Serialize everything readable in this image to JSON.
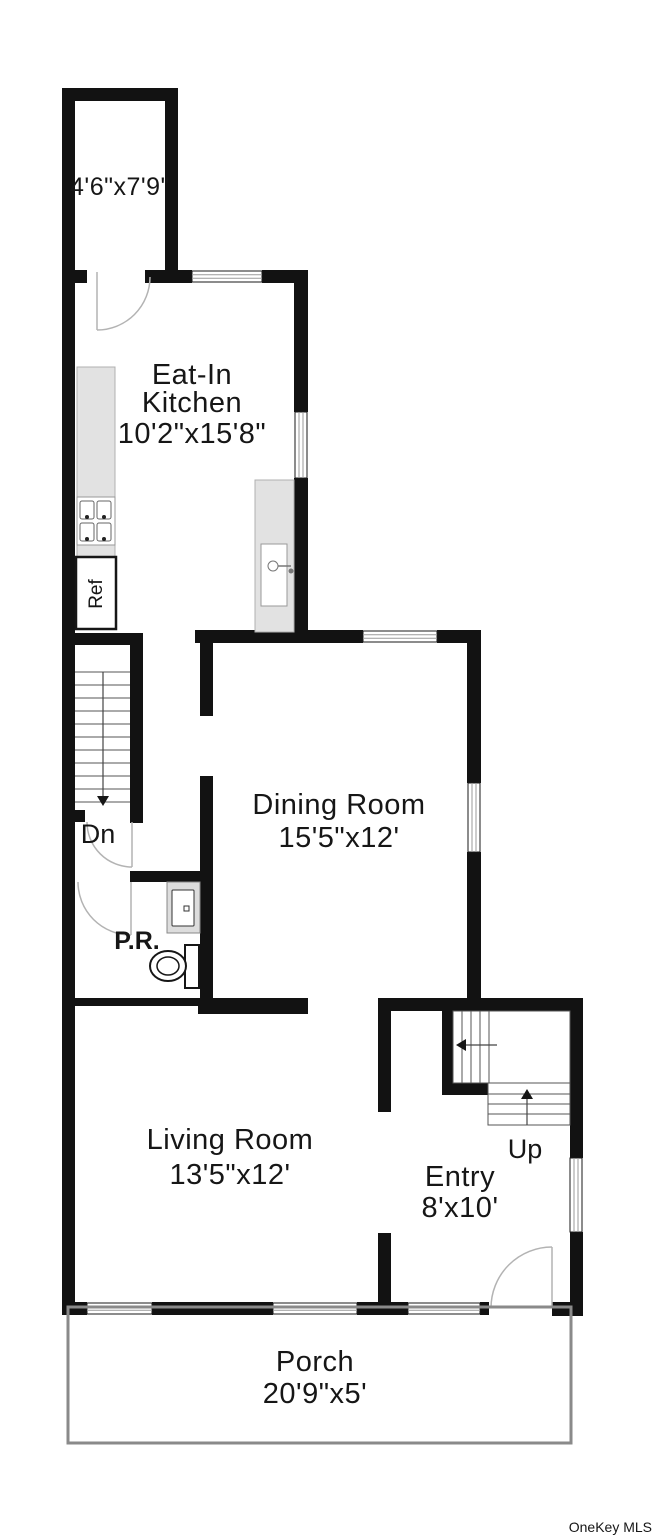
{
  "plan": {
    "closet": {
      "dims": "4'6\"x7'9\""
    },
    "kitchen": {
      "name_line1": "Eat-In",
      "name_line2": "Kitchen",
      "dims": "10'2\"x15'8\""
    },
    "fridge_label": "Ref",
    "stairs_down_label": "Dn",
    "dining": {
      "name": "Dining Room",
      "dims": "15'5\"x12'"
    },
    "powder_room_label": "P.R.",
    "living": {
      "name": "Living Room",
      "dims": "13'5\"x12'"
    },
    "entry": {
      "name": "Entry",
      "dims": "8'x10'"
    },
    "stairs_up_label": "Up",
    "porch": {
      "name": "Porch",
      "dims": "20'9\"x5'"
    },
    "colors": {
      "wall": "#121212",
      "counter": "#e2e2e2",
      "stair_text": "#4d4d4d",
      "porch_outline": "#8a8a8a",
      "watermark": "#c9c9c9"
    }
  },
  "watermark": "OneKey MLS"
}
